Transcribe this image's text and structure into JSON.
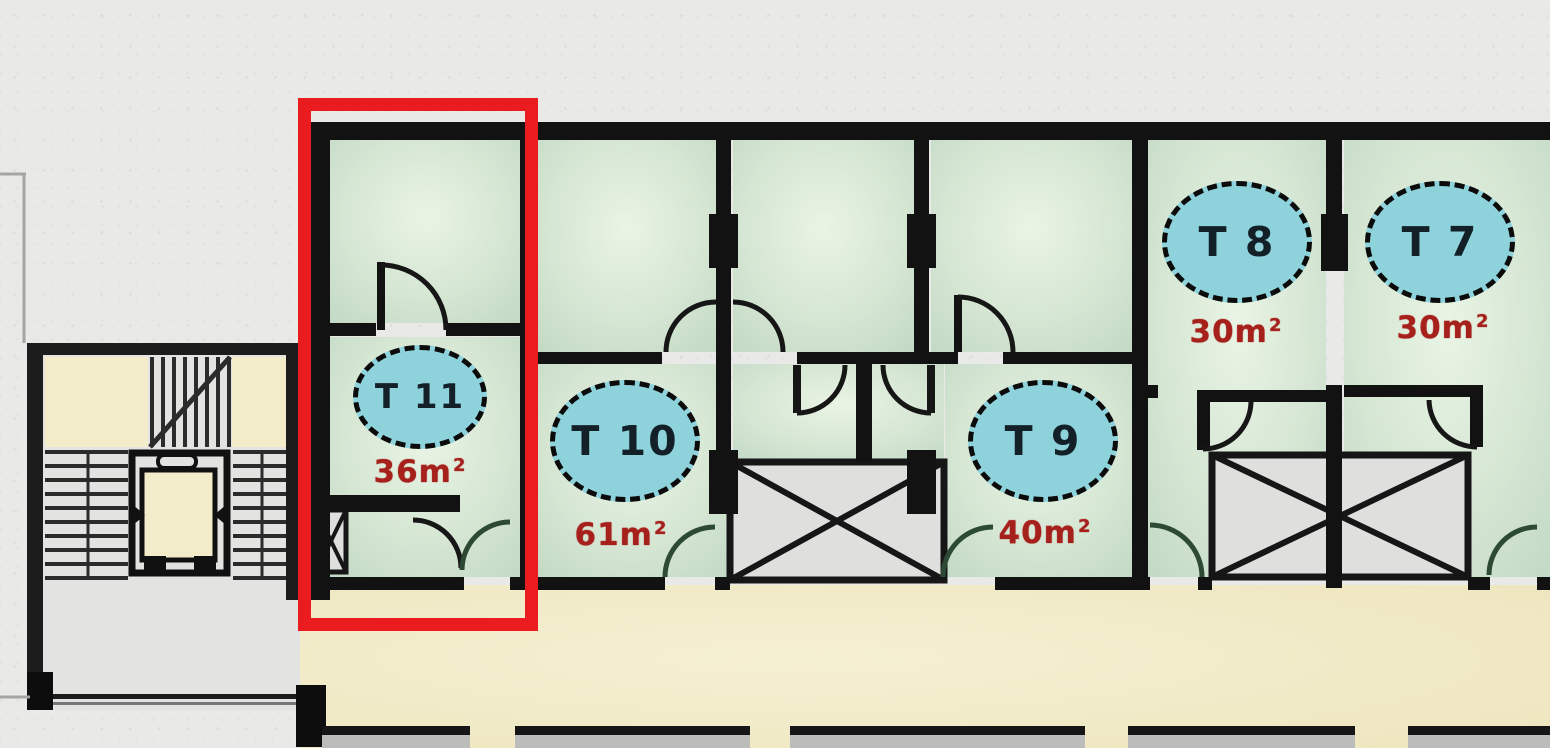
{
  "plan": {
    "units": [
      {
        "id": "T11",
        "label": "T 11",
        "area_value": "36",
        "area_unit": "m",
        "area_sup": "2",
        "highlighted": true
      },
      {
        "id": "T10",
        "label": "T 10",
        "area_value": "61",
        "area_unit": "m",
        "area_sup": "2",
        "highlighted": false
      },
      {
        "id": "T9",
        "label": "T 9",
        "area_value": "40",
        "area_unit": "m",
        "area_sup": "2",
        "highlighted": false
      },
      {
        "id": "T8",
        "label": "T 8",
        "area_value": "30",
        "area_unit": "m",
        "area_sup": "2",
        "highlighted": false
      },
      {
        "id": "T7",
        "label": "T 7",
        "area_value": "30",
        "area_unit": "m",
        "area_sup": "2",
        "highlighted": false
      }
    ],
    "symbols": {
      "stairs": "stairs-icon",
      "elevator": "elevator-icon",
      "shaft": "crossed-shaft-icon",
      "door": "door-arc-icon"
    },
    "colors": {
      "highlight": "#ea1c20",
      "unit_badge_fill": "#8ed3dc",
      "unit_badge_text": "#132028",
      "area_text": "#a6201c",
      "room_fill": "#d5e6d3",
      "corridor_fill": "#f2ecc9",
      "wall": "#121212",
      "background": "#e9e9e7"
    }
  }
}
